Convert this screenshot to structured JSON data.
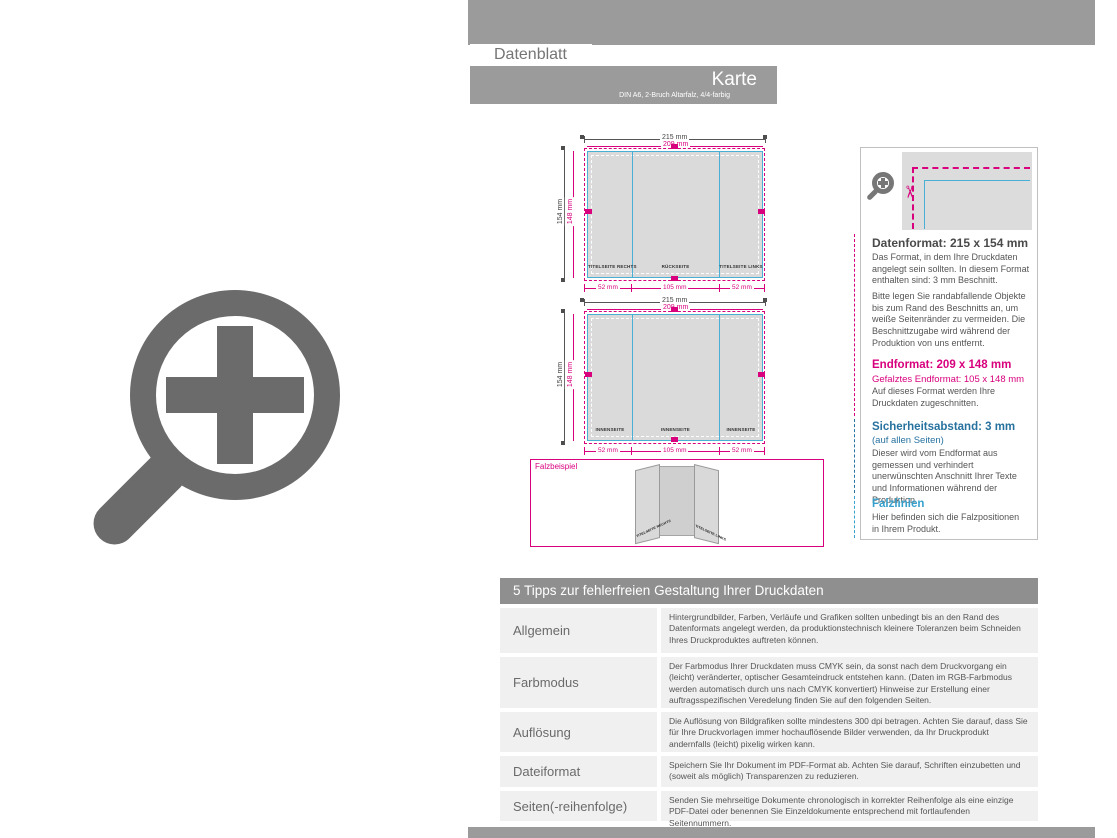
{
  "header": {
    "tab": "Datenblatt",
    "title": "Karte",
    "subtitle": "DIN A6, 2-Bruch Altarfalz, 4/4-farbig"
  },
  "diagrams": {
    "dims": {
      "w_outer": "215 mm",
      "w_inner": "209 mm",
      "h_outer": "154 mm",
      "h_inner": "148 mm",
      "seg_left": "52 mm",
      "seg_mid": "105 mm",
      "seg_right": "52 mm"
    },
    "top_panels": [
      "TITELSEITE RECHTS",
      "RÜCKSEITE",
      "TITELSEITE LINKS"
    ],
    "bottom_panels": [
      "INNENSEITE",
      "INNENSEITE",
      "INNENSEITE"
    ]
  },
  "fold_example": {
    "label": "Falzbeispiel",
    "flap_left": "TITELSEITE RECHTS",
    "flap_right": "TITELSEITE LINKS"
  },
  "info_panel": {
    "datenformat_heading": "Datenformat: 215 x 154 mm",
    "datenformat_p1": "Das Format, in dem Ihre Druckdaten angelegt sein sollten. In diesem Format enthalten sind: 3 mm Beschnitt.",
    "datenformat_p2": "Bitte legen Sie randabfallende Objekte bis zum Rand des Beschnitts an, um weiße Seitenränder zu vermeiden. Die Beschnittzugabe wird während der Produktion von uns entfernt.",
    "endformat_heading": "Endformat: 209 x 148 mm",
    "endformat_sub": "Gefalztes Endformat: 105 x 148 mm",
    "endformat_body": "Auf dieses Format werden Ihre Druckdaten zugeschnitten.",
    "sicherheit_heading": "Sicherheitsabstand: 3 mm",
    "sicherheit_sub": "(auf allen Seiten)",
    "sicherheit_body": "Dieser wird vom Endformat aus gemessen und verhindert unerwünschten Anschnitt Ihrer Texte und Informationen während der Produktion.",
    "falzlinien_heading": "Falzlinien",
    "falzlinien_body": "Hier befinden sich die Falzpositionen in Ihrem Produkt."
  },
  "tips": {
    "title": "5 Tipps zur fehlerfreien Gestaltung Ihrer Druckdaten",
    "rows": [
      {
        "label": "Allgemein",
        "text": "Hintergrundbilder, Farben, Verläufe und Grafiken sollten unbedingt bis an den Rand des Datenformats angelegt werden, da produktionstechnisch kleinere Toleranzen beim Schneiden Ihres Druckproduktes auftreten können."
      },
      {
        "label": "Farbmodus",
        "text": "Der Farbmodus Ihrer Druckdaten muss CMYK sein, da sonst nach dem Druckvorgang ein (leicht) veränderter, optischer Gesamteindruck entstehen kann. (Daten im RGB-Farbmodus werden automatisch durch uns nach CMYK konvertiert) Hinweise zur Erstellung einer auftragsspezifischen Veredelung finden Sie auf den folgenden Seiten."
      },
      {
        "label": "Auflösung",
        "text": "Die Auflösung von Bildgrafiken sollte mindestens 300 dpi betragen. Achten Sie darauf, dass Sie für Ihre Druckvorlagen immer hochauflösende Bilder verwenden, da Ihr Druckprodukt andernfalls (leicht) pixelig wirken kann."
      },
      {
        "label": "Dateiformat",
        "text": "Speichern Sie Ihr Dokument im PDF-Format ab. Achten Sie darauf, Schriften einzubetten und (soweit als möglich) Transparenzen zu reduzieren."
      },
      {
        "label": "Seiten(-reihenfolge)",
        "text": "Senden Sie mehrseitige Dokumente chronologisch in korrekter Reihenfolge als eine einzige PDF-Datei oder benennen Sie Einzeldokumente entsprechend mit fortlaufenden Seitennummern."
      }
    ]
  },
  "colors": {
    "magenta": "#d8007d",
    "cyan_line": "#4aafd4",
    "blue_safety": "#27729f",
    "blue_fold": "#36a0cc",
    "gray_band": "#9b9b9b"
  }
}
